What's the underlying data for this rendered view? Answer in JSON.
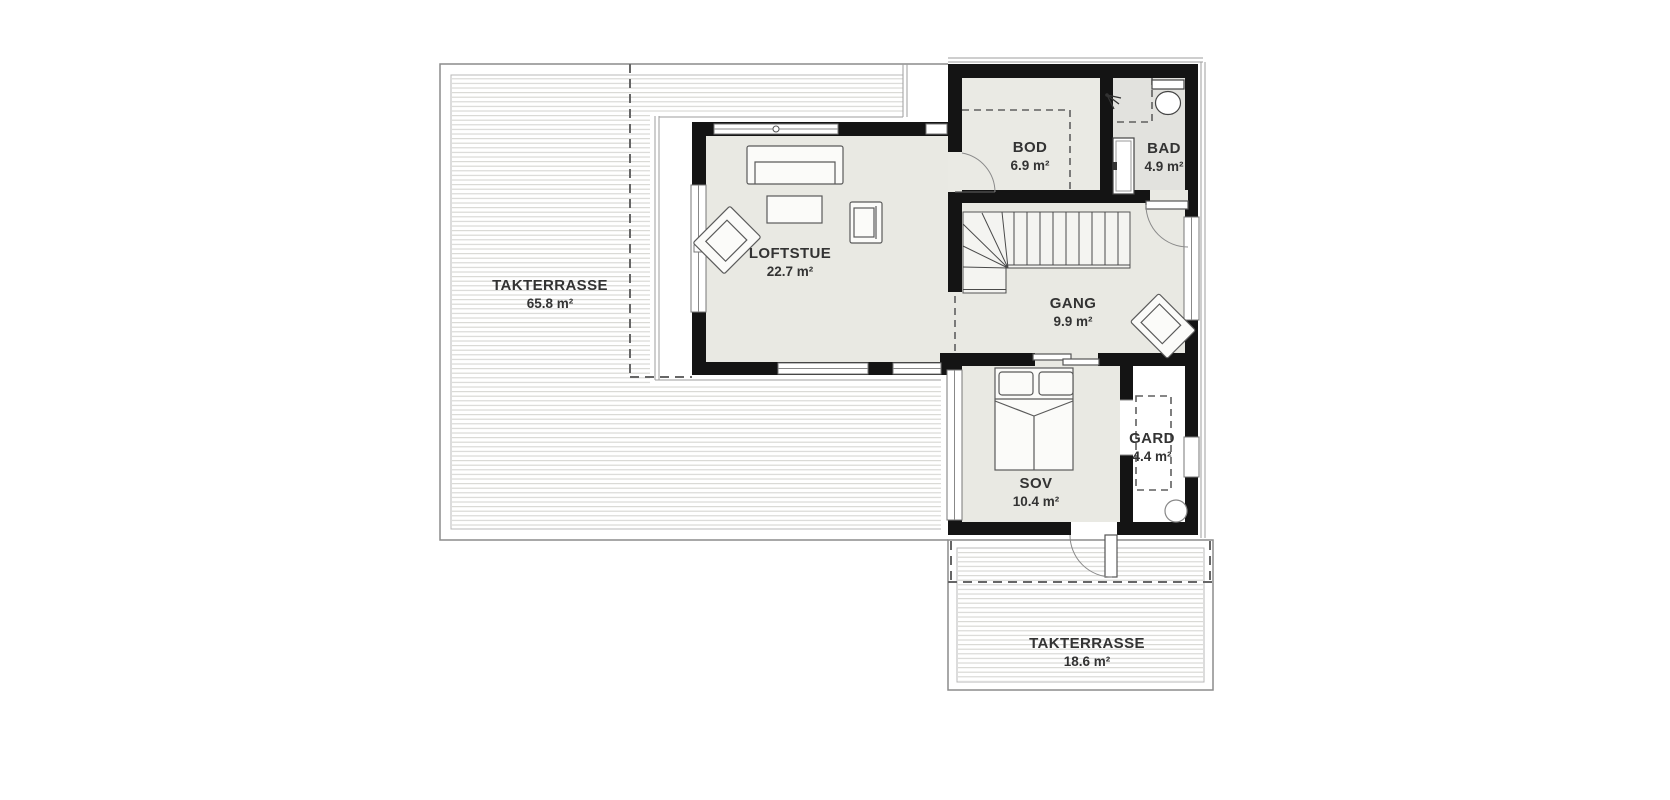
{
  "colors": {
    "wall": "#141414",
    "floor": "#e9e9e3",
    "floor-bod": "#eaeae4",
    "floor-bad": "#e2e2de",
    "floor-gard": "#ffffff",
    "deck-line": "#d6d6d2",
    "outline": "#8c8c8c",
    "text": "#333333"
  },
  "rooms": {
    "takterrasse_main": {
      "name": "TAKTERRASSE",
      "area": "65.8 m²"
    },
    "loftstue": {
      "name": "LOFTSTUE",
      "area": "22.7 m²"
    },
    "bod": {
      "name": "BOD",
      "area": "6.9 m²"
    },
    "bad": {
      "name": "BAD",
      "area": "4.9 m²"
    },
    "gang": {
      "name": "GANG",
      "area": "9.9 m²"
    },
    "sov": {
      "name": "SOV",
      "area": "10.4 m²"
    },
    "gard": {
      "name": "GARD",
      "area": "4.4 m²"
    },
    "takterrasse_lower": {
      "name": "TAKTERRASSE",
      "area": "18.6 m²"
    }
  }
}
